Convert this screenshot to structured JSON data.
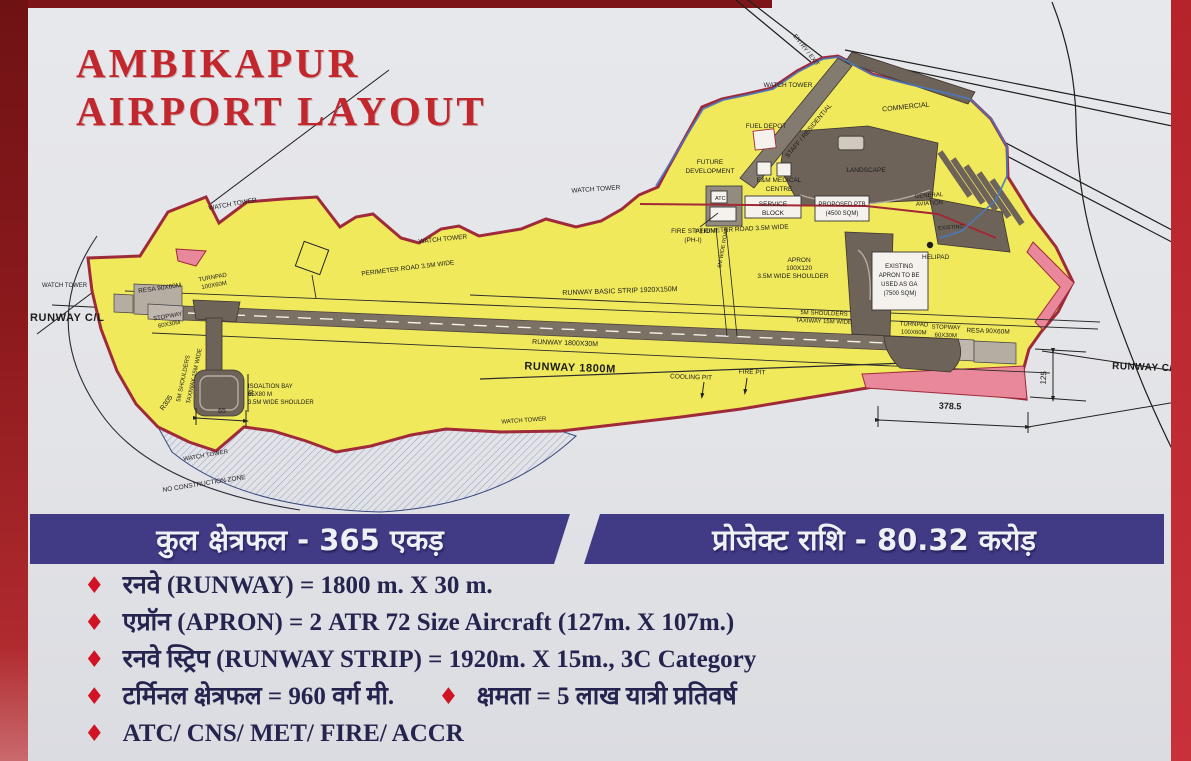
{
  "title": {
    "line1": "AMBIKAPUR",
    "line2": "AIRPORT LAYOUT"
  },
  "banner": {
    "total_area": "कुल क्षेत्रफल - 365 एकड़",
    "project_cost": "प्रोजेक्ट राशि - 80.32 करोड़"
  },
  "specs": {
    "bullet_icon": "♦",
    "items": [
      "रनवे (RUNWAY) = 1800 m. X 30 m.",
      "एप्रॉन (APRON) = 2 ATR 72 Size Aircraft (127m. X 107m.)",
      "रनवे स्ट्रिप (RUNWAY STRIP) = 1920m. X 15m., 3C Category",
      "टर्मिनल क्षेत्रफल = 960 वर्ग मी.",
      "क्षमता = 5 लाख यात्री प्रतिवर्ष",
      "ATC/ CNS/ MET/ FIRE/ ACCR"
    ]
  },
  "map": {
    "labels": {
      "watch_tower": "WATCH TOWER",
      "runway_cl": "RUNWAY C/L",
      "resa_90x60m": "RESA 90X60M",
      "turnpad": "TURNPAD",
      "turnpad_size": "100X60M",
      "stopway": "STOPWAY",
      "stopway_size": "60X30M",
      "shoulders_line1": "5M SHOULDERS",
      "shoulders_line2": "TAXIWAY 15M WIDE",
      "isolation_l1": "ISOALTION BAY",
      "isolation_l2": "65X80 M",
      "isolation_l3": "3.5M WIDE SHOULDER",
      "perimeter_road": "PERIMETER ROAD 3.5M WIDE",
      "basic_strip": "RUNWAY BASIC STRIP 1920X150M",
      "runway_1800x30": "RUNWAY 1800X30M",
      "runway_1800": "RUNWAY 1800M",
      "cooling_pit": "COOLING PIT",
      "fire_pit": "FIRE PIT",
      "fuel_depot": "FUEL DEPOT",
      "future_l1": "FUTURE",
      "future_l2": "DEVELOPMENT",
      "em_l1": "E&M MEDICAL",
      "em_l2": "CENTRE",
      "service_l1": "SERVICE",
      "service_l2": "BLOCK",
      "ptb_l1": "PROPOSED PTB",
      "ptb_l2": "(4500 SQM)",
      "landscape": "LANDSCAPE",
      "staff_residential": "STAFF / RESIDENTIAL",
      "commercial": "COMMERCIAL",
      "general_l1": "GENERAL",
      "general_l2": "AVIATION",
      "existing": "EXISTING",
      "atc": "ATC",
      "fire_station_l1": "FIRE STATION",
      "fire_station_l2": "(PH-I)",
      "apron_l1": "APRON",
      "apron_l2": "100X120",
      "apron_l3": "3.5M WIDE SHOULDER",
      "existing_apron_l1": "EXISTING",
      "existing_apron_l2": "APRON TO BE",
      "existing_apron_l3": "USED AS GA",
      "existing_apron_l4": "(7500 SQM)",
      "helipad": "HELIPAD",
      "road_6m": "6M WIDE ROAD",
      "entry_exit": "ENTRY / EXIT",
      "no_construction": "NO CONSTRUCTION ZONE",
      "dim_65": "65",
      "dim_90": "90",
      "dim_r305": "R305",
      "dim_125": "125",
      "dim_378": "378.5"
    }
  },
  "palette": {
    "board_bg": "#e3e4e8",
    "frame_red_dark": "#8a191c",
    "frame_red_bright": "#c2272e",
    "title_red": "#c1272d",
    "banner_purple": "#413b86",
    "bullet_navy": "#24244f",
    "diamond_red": "#d01426",
    "land_yellow": "#f1e95c",
    "boundary_maroon": "#9e2a3a",
    "runway_gray": "#7b7265",
    "structure_gray": "#6e6358",
    "light_gray": "#b5aca2",
    "pink": "#e8889a",
    "complex_blue": "#4a78c0"
  }
}
